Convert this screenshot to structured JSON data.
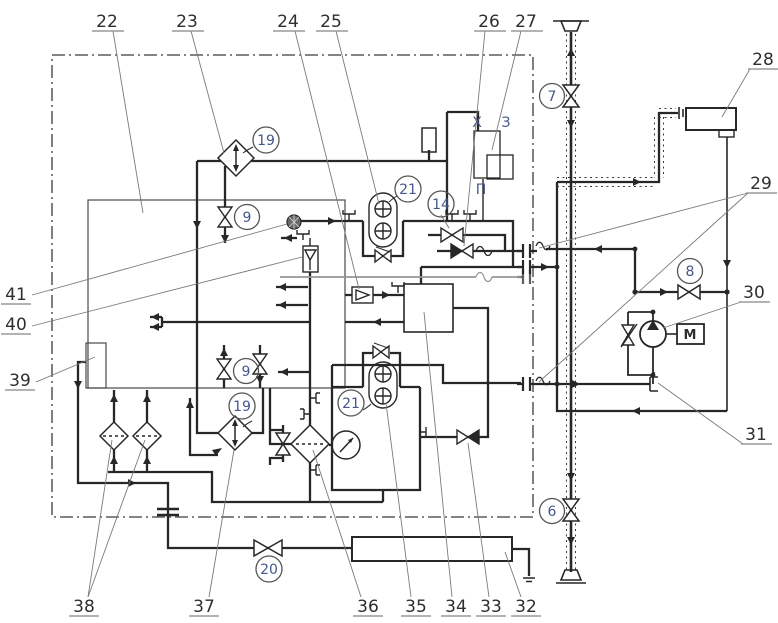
{
  "diagram": {
    "type": "hydraulic-pneumatic-schematic",
    "callouts": {
      "c22": "22",
      "c23": "23",
      "c24": "24",
      "c25": "25",
      "c26": "26",
      "c27": "27",
      "c28": "28",
      "c29": "29",
      "c30": "30",
      "c31": "31",
      "c32": "32",
      "c33": "33",
      "c34": "34",
      "c35": "35",
      "c36": "36",
      "c37": "37",
      "c38": "38",
      "c39": "39",
      "c40": "40",
      "c41": "41"
    },
    "circled": {
      "n6": "6",
      "n7": "7",
      "n8": "8",
      "n9a": "9",
      "n9b": "9",
      "n14": "14",
      "n19a": "19",
      "n19b": "19",
      "n20": "20",
      "n21a": "21",
      "n21b": "21"
    },
    "letters": {
      "x": "Х",
      "z": "З",
      "p": "П",
      "m": "М"
    },
    "colors": {
      "ink": "#2b2b2b",
      "leader": "#7a7a7a",
      "secondary_line": "#969696",
      "circled_text": "#46568e"
    }
  }
}
